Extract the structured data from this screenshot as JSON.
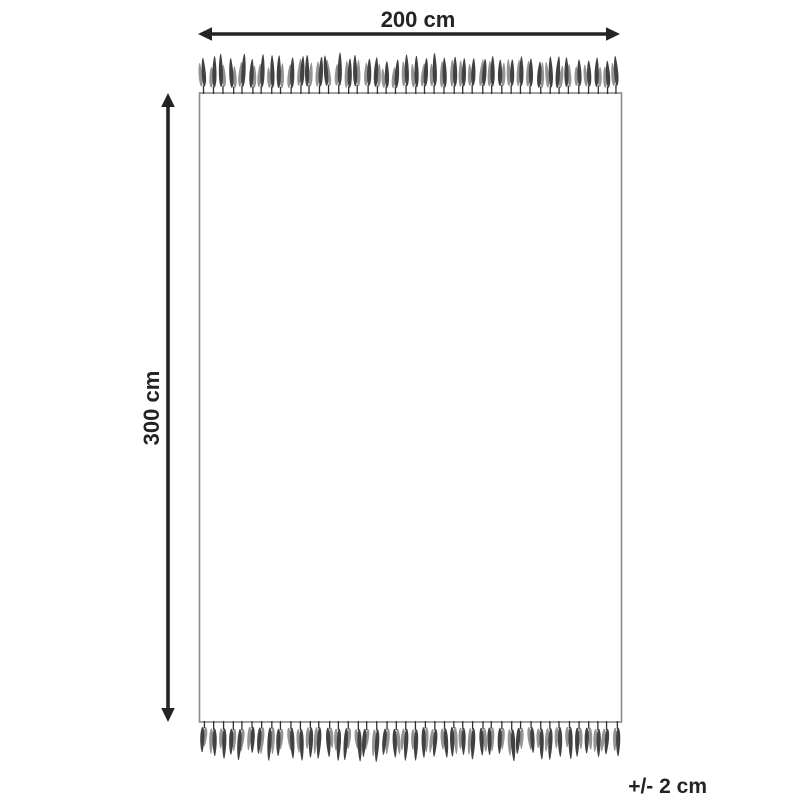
{
  "diagram": {
    "labels": {
      "width": "200 cm",
      "height": "300 cm",
      "tolerance": "+/- 2 cm"
    },
    "colors": {
      "background": "#ffffff",
      "dimension": "#242424",
      "text": "#242424",
      "rug_outline": "#8a8a8a",
      "fringe_dark": "#414141",
      "fringe_light": "#949494",
      "fringe_stem": "#303030"
    },
    "fringe": {
      "strand_count": 44
    }
  }
}
